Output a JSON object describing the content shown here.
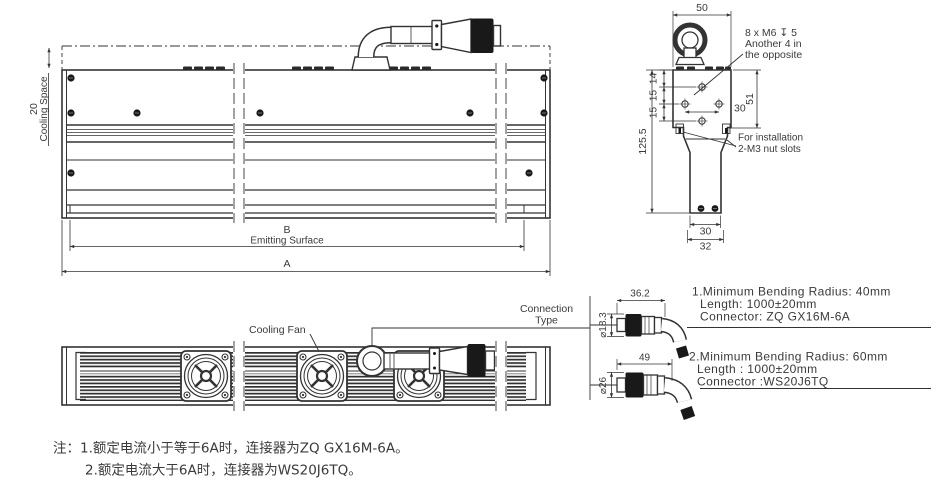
{
  "page": {
    "background": "#ffffff",
    "line_color": "#333333"
  },
  "front_view": {
    "cooling_space_dim": "20",
    "cooling_space_label": "Cooling Space",
    "emitting_dim_letter": "B",
    "emitting_label": "Emitting Surface",
    "overall_dim_letter": "A"
  },
  "side_view": {
    "top_width_dim": "50",
    "thread_note": [
      "8 x M6 ↧ 5",
      "Another 4 in",
      "the opposite"
    ],
    "pitch_dims": [
      "14",
      "15",
      "15"
    ],
    "hole_span_dim": "30",
    "section_height_dim": "51",
    "overall_height_dim": "125.5",
    "install_note": [
      "For installation",
      "2-M3 nut slots"
    ],
    "bottom_inner_width_dim": "30",
    "bottom_outer_width_dim": "32"
  },
  "bottom_view": {
    "cooling_fan_label": "Cooling Fan",
    "connection_type_line1": "Connection",
    "connection_type_line2": "Type"
  },
  "connector_options": [
    {
      "length_dim": "36.2",
      "diameter_dim": "⌀18.3",
      "specs": [
        "1.Minimum Bending Radius: 40mm",
        "Length: 1000±20mm",
        "Connector: ZQ GX16M-6A"
      ]
    },
    {
      "length_dim": "49",
      "diameter_dim": "⌀26",
      "specs": [
        "2.Minimum Bending Radius: 60mm",
        "Length : 1000±20mm",
        "Connector :WS20J6TQ"
      ]
    }
  ],
  "notes": {
    "line1": "注：1.额定电流小于等于6A时，连接器为ZQ GX16M-6A。",
    "line2": "2.额定电流大于6A时，连接器为WS20J6TQ。"
  }
}
